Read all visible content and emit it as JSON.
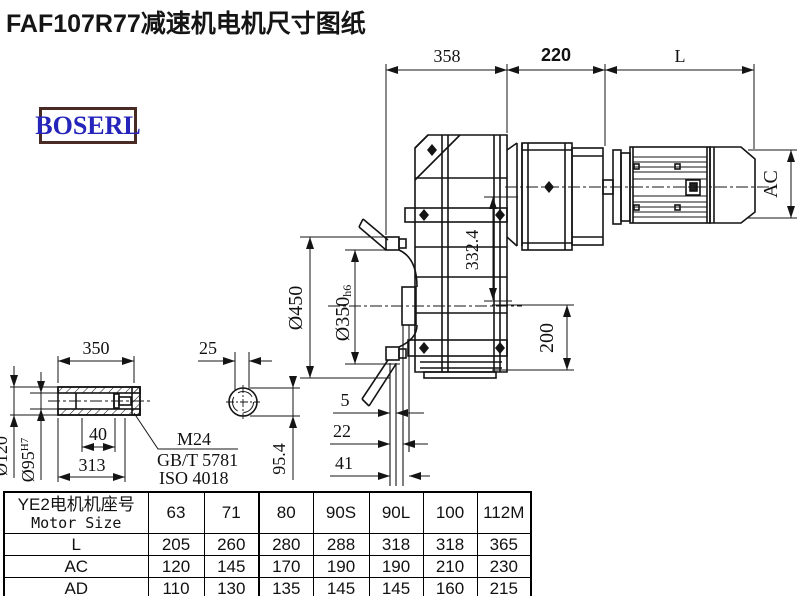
{
  "title": "FAF107R77减速机电机尺寸图纸",
  "logo": {
    "text": "BOSERL"
  },
  "colors": {
    "line": "#141414",
    "logo_border": "#492a24",
    "logo_text": "#2525bb"
  },
  "drawing": {
    "dims": {
      "top_358": "358",
      "top_220": "220",
      "top_L": "L",
      "ac": "AC",
      "v332": "332.4",
      "v200": "200",
      "d450": "Ø450",
      "d350": "Ø350",
      "d350_suffix": "h6",
      "s5": "5",
      "s22": "22",
      "s41": "41",
      "shaft_350": "350",
      "shaft_25": "25",
      "shaft_40": "40",
      "shaft_313": "313",
      "d120": "Ø120",
      "d95": "Ø95",
      "d95_sup": "H7",
      "v954": "95.4",
      "m24": "M24",
      "gbt": "GB/T 5781",
      "iso": "ISO 4018"
    }
  },
  "table": {
    "header_cn": "YE2电机机座号",
    "header_en": "Motor Size",
    "sizes": [
      "63",
      "71",
      "80",
      "90S",
      "90L",
      "100",
      "112M"
    ],
    "rows": [
      {
        "label": "L",
        "values": [
          "205",
          "260",
          "280",
          "288",
          "318",
          "318",
          "365"
        ]
      },
      {
        "label": "AC",
        "values": [
          "120",
          "145",
          "170",
          "190",
          "190",
          "210",
          "230"
        ]
      },
      {
        "label": "AD",
        "values": [
          "110",
          "130",
          "135",
          "145",
          "145",
          "160",
          "215"
        ]
      }
    ]
  }
}
